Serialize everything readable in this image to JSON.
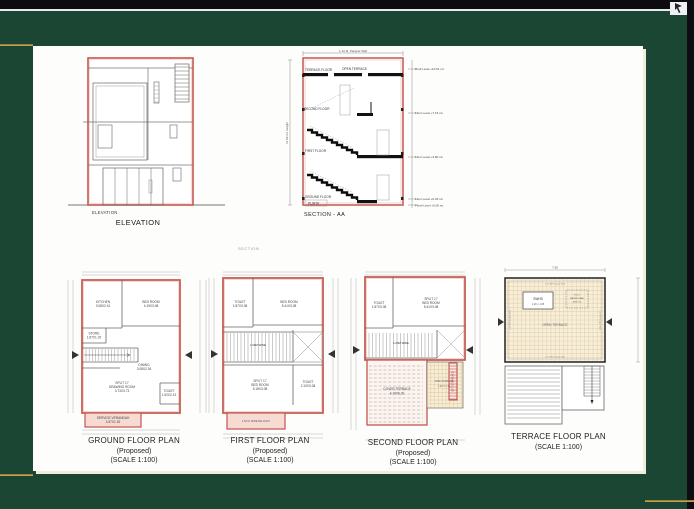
{
  "elevation": {
    "label_small": "ELEVATION",
    "label": "ELEVATION"
  },
  "section": {
    "title": "SECTION - AA",
    "mini_title": "SECTION",
    "floor_labels": {
      "terrace": "TERRACE FLOOR",
      "open_terrace": "OPEN TERRACE",
      "second": "SECOND FLOOR",
      "first": "FIRST FLOOR",
      "ground": "GROUND FLOOR",
      "plinth": "PLINTH"
    },
    "levels": {
      "roof": "Roof Level +10.51 mt.",
      "second": "Floor Level +7.16 mt.",
      "first": "Floor Level +3.80 mt.",
      "ground": "Floor Level +0.45 mt.",
      "plinth": "Plinth Level +0.00 mt."
    },
    "parapet_note": "1.10 M. Parapet Wall",
    "height_note": "11.89 mt. Height"
  },
  "ground_plan": {
    "title": "GROUND FLOOR PLAN",
    "subtitle": "(Proposed)",
    "scale": "(SCALE 1:100)",
    "kitchen": {
      "name": "KITCHEN",
      "dim": "3.08X2.41"
    },
    "bedroom": {
      "name": "BED ROOM",
      "dim": "4.19X3.08"
    },
    "store": {
      "name": "STORE",
      "dim": "1.87X1.20"
    },
    "dining": {
      "name": "DINING",
      "dim": "3.08X2.34"
    },
    "drawing_room": {
      "line1": "SPLIT 17",
      "name": "DRAWING ROOM",
      "dim": "3.73X3.73"
    },
    "toilet": {
      "name": "TOILET",
      "dim": "1.52X2.13"
    },
    "verandah": {
      "name": "SERVICE VERANDAH",
      "dim": "4.57X1.52"
    }
  },
  "first_plan": {
    "title": "FIRST FLOOR PLAN",
    "subtitle": "(Proposed)",
    "scale": "(SCALE 1:100)",
    "toilet1": {
      "name": "TOILET",
      "dim": "1.87X3.08"
    },
    "bedroom1": {
      "name": "BED ROOM",
      "dim": "5.41X3.08"
    },
    "stair_note": "1.06M WIDE",
    "bedroom2": {
      "line1": "SPLIT 17",
      "name": "BED ROOM",
      "dim": "5.18X3.08"
    },
    "toilet2": {
      "name": "TOILET",
      "dim": "2.10X3.08"
    },
    "balcony": "1.52 M. WIDE BALCONY"
  },
  "second_plan": {
    "title": "SECOND FLOOR PLAN",
    "subtitle": "(Proposed)",
    "scale": "(SCALE 1:100)",
    "toilet": {
      "name": "TOILET",
      "dim": "1.87X3.08"
    },
    "bedroom": {
      "line1": "SPLIT 17",
      "name": "BED ROOM",
      "dim": "5.41X3.08"
    },
    "stair_note": "1.06M WIDE",
    "cover_terrace": {
      "name": "COVER TERRACE",
      "dim": "4.19X6.20"
    },
    "open_terrace": {
      "name": "OPEN TERRACE",
      "dim": "1.20 X 2.75"
    },
    "ladder": "UP TO TERRACE"
  },
  "terrace_plan": {
    "title": "TERRACE FLOOR PLAN",
    "scale": "(SCALE 1:100)",
    "swhs": {
      "name": "SWHS",
      "dim": "1.20 x 1.05"
    },
    "tank": {
      "line1": "P.V.C",
      "line2": "WATER TANK",
      "line3": "(500 LT.)"
    },
    "open_terrace": "OPEN TERRACE",
    "parapet": "1.10 M Parapet Wall",
    "width_dim": "7.55"
  }
}
